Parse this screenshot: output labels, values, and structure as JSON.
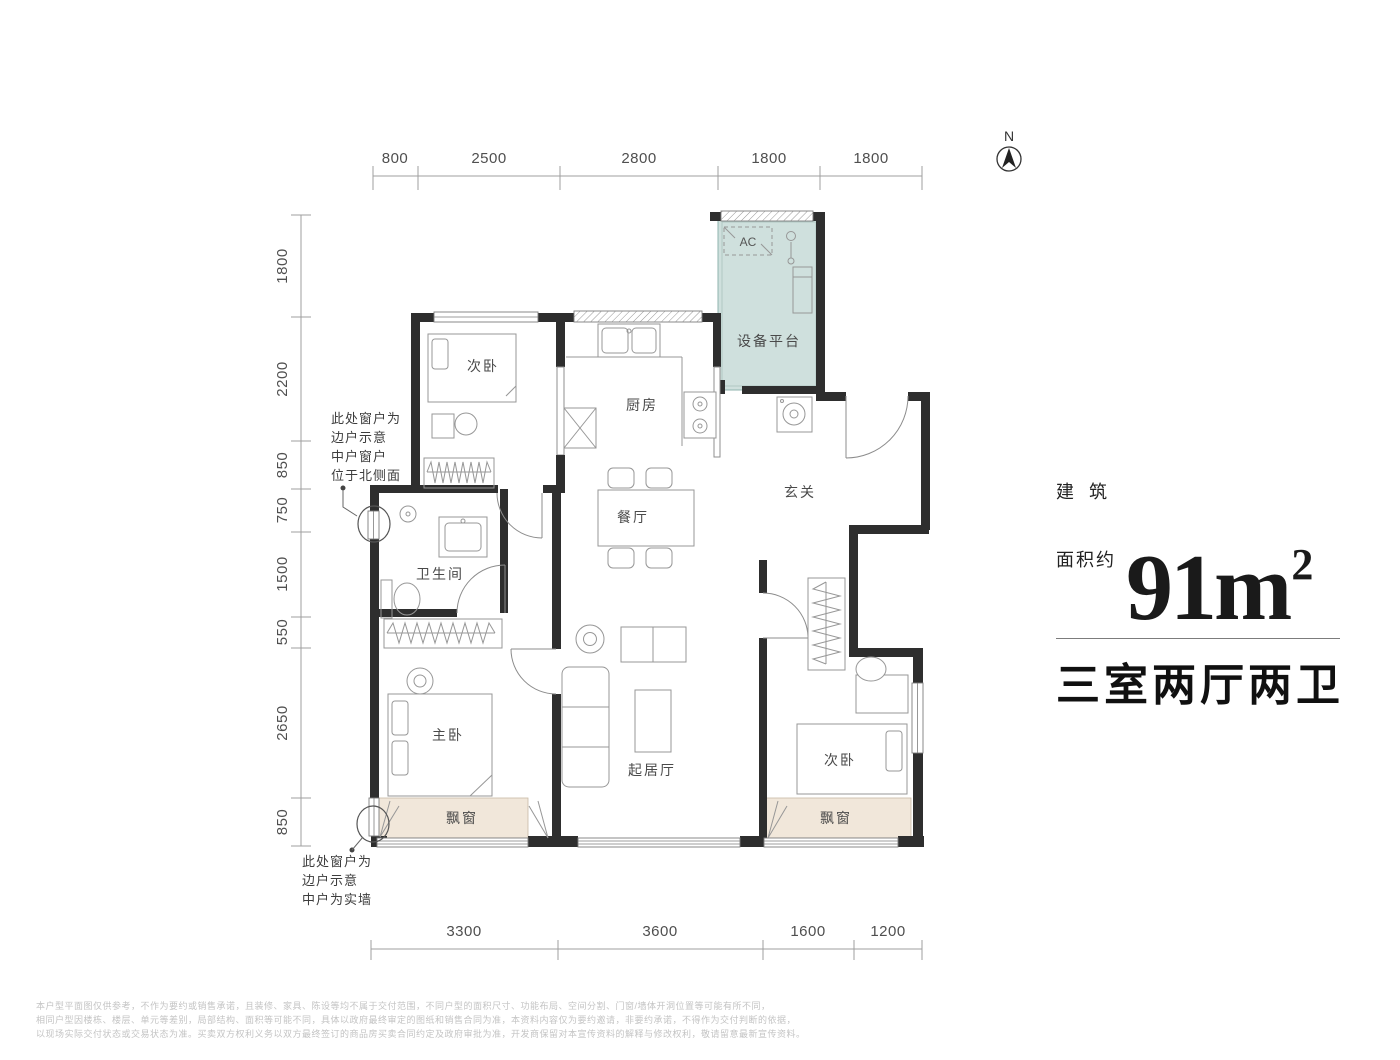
{
  "north": {
    "label": "N"
  },
  "dimensions": {
    "top": [
      "800",
      "2500",
      "2800",
      "1800",
      "1800"
    ],
    "left": [
      "1800",
      "2200",
      "850",
      "750",
      "1500",
      "550",
      "2650",
      "850"
    ],
    "bottom": [
      "3300",
      "3600",
      "1600",
      "1200"
    ]
  },
  "rooms": {
    "bedroom_north": "次卧",
    "kitchen": "厨房",
    "equipment_platform": "设备平台",
    "foyer": "玄关",
    "dining": "餐厅",
    "bathroom": "卫生间",
    "master_bedroom": "主卧",
    "living": "起居厅",
    "bedroom_south": "次卧",
    "bay_window_left": "飘窗",
    "bay_window_right": "飘窗",
    "ac_unit": "AC"
  },
  "annotations": {
    "north_window": [
      "此处窗户为",
      "边户示意",
      "中户窗户",
      "位于北侧面"
    ],
    "south_window": [
      "此处窗户为",
      "边户示意",
      "中户为实墙"
    ]
  },
  "area_panel": {
    "prefix_top": "建  筑",
    "prefix_bottom": "面积约",
    "value": "91m",
    "value_sup": "2",
    "layout": "三室两厅两卫"
  },
  "disclaimer": [
    "本户型平面图仅供参考，不作为要约或销售承诺，且装修、家具、陈设等均不属于交付范围，不同户型的面积尺寸、功能布局、空间分割、门窗/墙体开洞位置等可能有所不同，",
    "相同户型因楼栋、楼层、单元等差别，局部结构、面积等可能不同，具体以政府最终审定的图纸和销售合同为准，本资料内容仅为要约邀请，非要约承诺，不得作为交付判断的依据，",
    "以现场实际交付状态或交易状态为准。买卖双方权利义务以双方最终签订的商品房买卖合同约定及政府审批为准，开发商保留对本宣传资料的解释与修改权利，敬请留意最新宣传资料。"
  ],
  "colors": {
    "wall": "#2e2e2e",
    "equipment_fill": "#cfe0dd",
    "equipment_border": "#8fb3ae",
    "bay_fill": "#f1e7da",
    "bay_border": "#c9baa5",
    "dim_text": "#4f4f4f",
    "furniture_line": "#979797",
    "disclaimer_text": "#c4c4c4"
  }
}
